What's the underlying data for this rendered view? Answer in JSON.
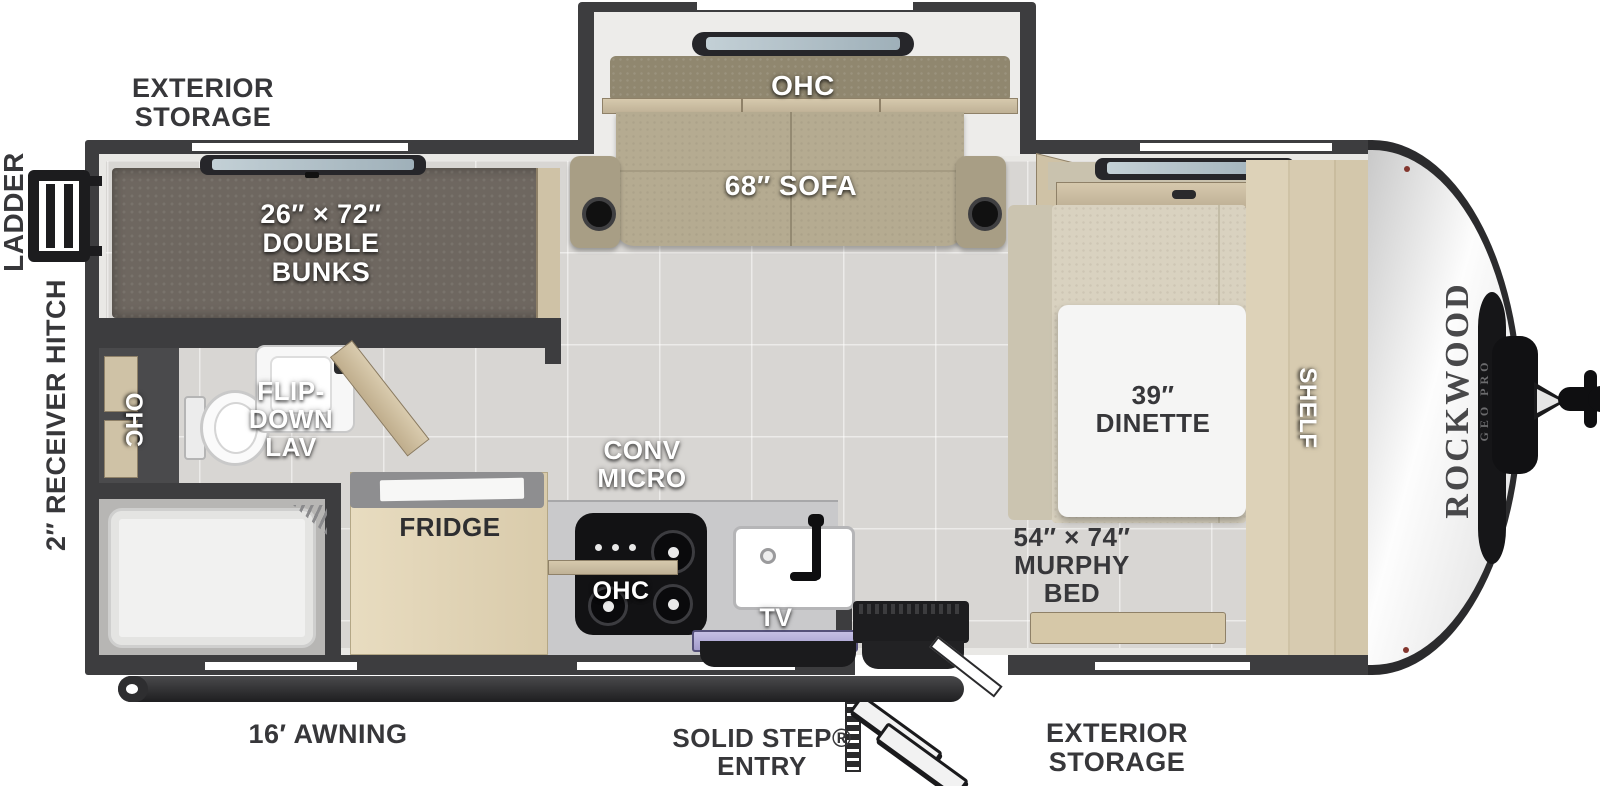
{
  "title": "Rockwood Geo Pro travel trailer floor plan",
  "colors": {
    "wall": "#3d3d3f",
    "floor": "#d8d6d3",
    "wood": "#d2c5a9",
    "sofa": "#b4aa90",
    "bunk_mattress": "#6e6760",
    "bed_mattress": "#d9d2c0",
    "counter": "#c9c9cb",
    "appliance_black": "#161618",
    "window_glass": "#b7c4cb",
    "sink_cover_lavender": "#b3add8",
    "nose_white": "#f2f2f2",
    "label_dark": "#37373a",
    "label_white": "#ffffff"
  },
  "labels": {
    "exterior_storage_top": [
      "EXTERIOR",
      "STORAGE"
    ],
    "ladder": "LADDER",
    "receiver_hitch": "2″ RECEIVER HITCH",
    "slide_ohc": "OHC",
    "sofa": "68″ SOFA",
    "bunks": [
      "26″ × 72″",
      "DOUBLE",
      "BUNKS"
    ],
    "flip_down_lav": [
      "FLIP-",
      "DOWN",
      "LAV"
    ],
    "bath_ohc": "OHC",
    "fridge": "FRIDGE",
    "conv_micro": [
      "CONV",
      "MICRO"
    ],
    "kitchen_ohc": "OHC",
    "tv": "TV",
    "dinette": [
      "39″",
      "DINETTE"
    ],
    "murphy_bed": [
      "54″ × 74″",
      "MURPHY",
      "BED"
    ],
    "shelf": "SHELF",
    "brand": "ROCKWOOD",
    "brand_sub": "GEO PRO",
    "awning": "16′ AWNING",
    "entry": [
      "SOLID STEP®",
      "ENTRY"
    ],
    "exterior_storage_bottom": [
      "EXTERIOR",
      "STORAGE"
    ]
  }
}
